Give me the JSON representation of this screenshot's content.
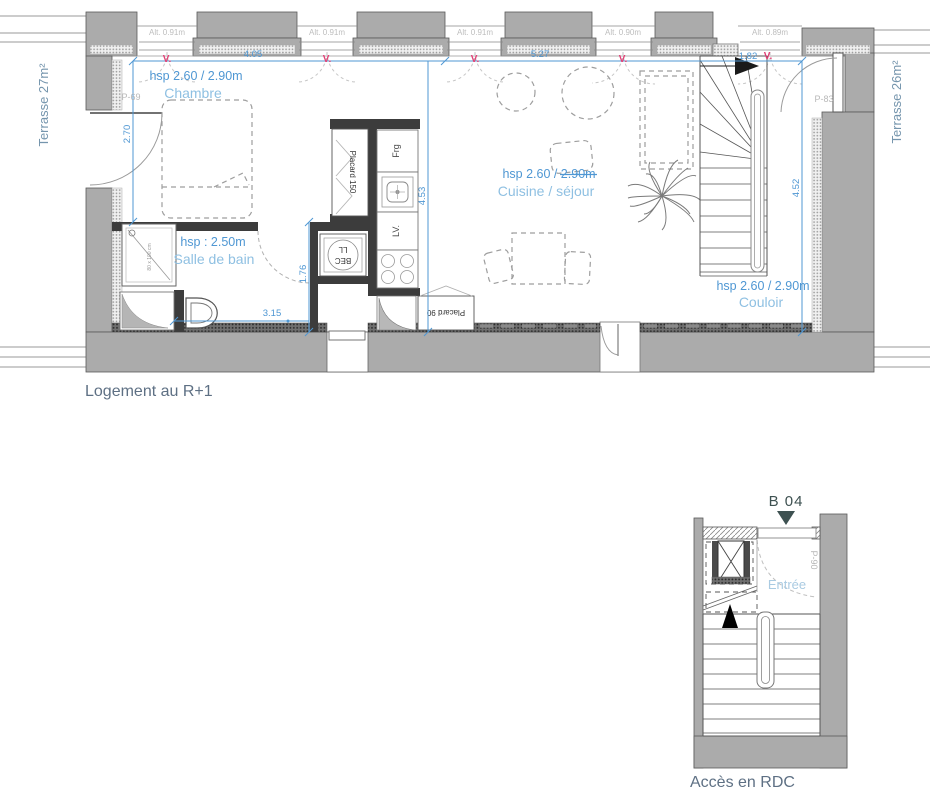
{
  "captions": {
    "main": "Logement au R+1",
    "rdc": "Accès en RDC"
  },
  "unit": {
    "label": "B 04"
  },
  "terraces": {
    "left": "Terrasse 27m²",
    "right": "Terrasse 26m²"
  },
  "rooms": {
    "chambre": {
      "hsp": "hsp 2.60 / 2.90m",
      "name": "Chambre"
    },
    "bath": {
      "hsp": "hsp : 2.50m",
      "name": "Salle de bain"
    },
    "cuisine": {
      "hsp": "hsp 2.60 / 2.90m",
      "name": "Cuisine / séjour"
    },
    "couloir": {
      "hsp": "hsp 2.60 / 2.90m",
      "name": "Couloir"
    },
    "entree": {
      "name": "Entrée"
    }
  },
  "dims": {
    "d405": "4.05",
    "d527": "5.27",
    "d182": "1.82",
    "d270": "2.70",
    "d453": "4.53",
    "d452": "4.52",
    "d176": "1.76",
    "d315": "3.15"
  },
  "windows": {
    "w1": "Alt. 0.91m",
    "w2": "Alt. 0.91m",
    "w3": "Alt. 0.91m",
    "w4": "Alt. 0.90m",
    "w5": "Alt. 0.89m",
    "vent": "V."
  },
  "doors": {
    "left": "P-69",
    "right": "P-83",
    "rdc": "P-90"
  },
  "fixtures": {
    "placard150": "Placard 150",
    "placard90": "Placard 90",
    "fridge": "Frg",
    "dishwasher": "LV.",
    "washer1": "BEC",
    "washer2": "LL",
    "shower": "80 x 100 cm"
  },
  "colors": {
    "dimension_blue": "#4f97d3",
    "room_label_blue": "#8fc0e2",
    "entree_blue": "#aacbe2",
    "vent_red": "#e23f75",
    "wall_gray": "#ababab",
    "partition_dark": "#3c3c3c",
    "caption_gray": "#5e7084",
    "unit_dark": "#3e5151",
    "door_label_gray": "#b8b8b8",
    "alt_label_gray": "#bdbdbd",
    "terrace_label": "#7595ad"
  }
}
